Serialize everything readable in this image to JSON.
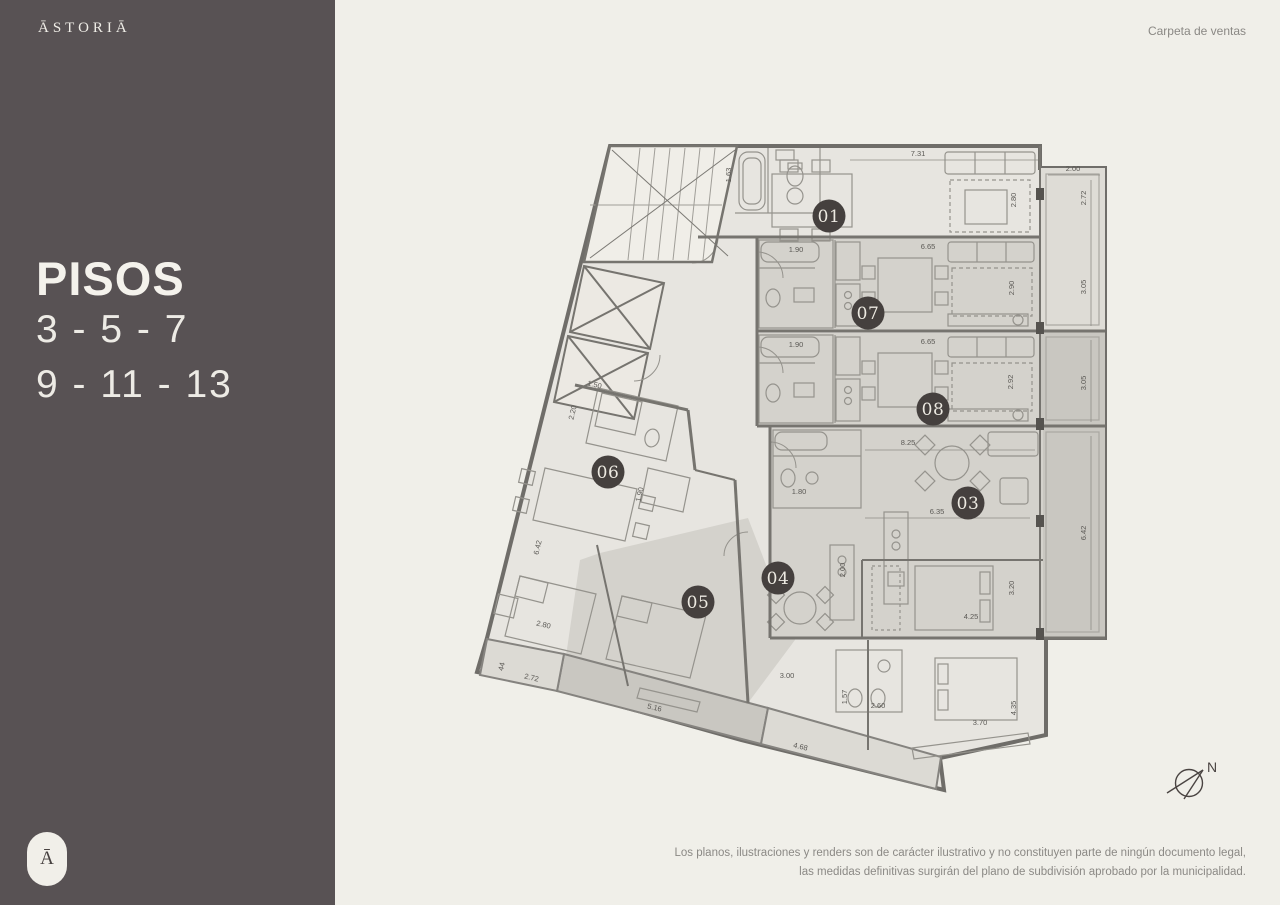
{
  "brand": {
    "logo": "ĀSTORIĀ",
    "monogram": "Ā"
  },
  "header": {
    "right_label": "Carpeta de ventas"
  },
  "sidebar": {
    "title": "PISOS",
    "line1": "3 - 5 - 7",
    "line2": "9 - 11 - 13"
  },
  "footer": {
    "disclaimer_line1": "Los planos, ilustraciones y renders son de carácter ilustrativo y no constituyen parte de ningún documento legal,",
    "disclaimer_line2": "las medidas definitivas surgirán del plano de subdivisión aprobado por la municipalidad."
  },
  "compass": {
    "label": "N"
  },
  "colors": {
    "sidebar": "#585254",
    "background": "#f0efe9",
    "badge": "#45403e",
    "badge_text": "#ece9e1",
    "plan_light": "#e7e5e0",
    "plan_shaded": "#d4d2cc",
    "balcony_dark": "#c9c7c1"
  },
  "plan": {
    "units": [
      {
        "n": "01",
        "x": 829,
        "y": 216
      },
      {
        "n": "07",
        "x": 868,
        "y": 313
      },
      {
        "n": "08",
        "x": 933,
        "y": 409
      },
      {
        "n": "03",
        "x": 968,
        "y": 503
      },
      {
        "n": "06",
        "x": 608,
        "y": 472
      },
      {
        "n": "04",
        "x": 778,
        "y": 578
      },
      {
        "n": "05",
        "x": 698,
        "y": 602
      }
    ],
    "dimensions": [
      {
        "t": "7.31",
        "x": 918,
        "y": 156,
        "r": 0
      },
      {
        "t": "1.63",
        "x": 731,
        "y": 175,
        "r": -90
      },
      {
        "t": "2.00",
        "x": 1073,
        "y": 171,
        "r": 0
      },
      {
        "t": "2.72",
        "x": 1086,
        "y": 198,
        "r": -90
      },
      {
        "t": "2.80",
        "x": 1016,
        "y": 200,
        "r": -90
      },
      {
        "t": "1.90",
        "x": 796,
        "y": 252,
        "r": 0
      },
      {
        "t": "6.65",
        "x": 928,
        "y": 249,
        "r": 0
      },
      {
        "t": "2.90",
        "x": 1014,
        "y": 288,
        "r": -90
      },
      {
        "t": "3.05",
        "x": 1086,
        "y": 287,
        "r": -90
      },
      {
        "t": "1.90",
        "x": 796,
        "y": 347,
        "r": 0
      },
      {
        "t": "6.65",
        "x": 928,
        "y": 344,
        "r": 0
      },
      {
        "t": "2.92",
        "x": 1013,
        "y": 382,
        "r": -90
      },
      {
        "t": "3.05",
        "x": 1086,
        "y": 383,
        "r": -90
      },
      {
        "t": "8.25",
        "x": 908,
        "y": 445,
        "r": 0
      },
      {
        "t": "1.80",
        "x": 799,
        "y": 494,
        "r": 0
      },
      {
        "t": "6.35",
        "x": 937,
        "y": 514,
        "r": 0
      },
      {
        "t": "6.42",
        "x": 1086,
        "y": 533,
        "r": -90
      },
      {
        "t": "1.50",
        "x": 594,
        "y": 387,
        "r": 13
      },
      {
        "t": "2.20",
        "x": 575,
        "y": 413,
        "r": -77
      },
      {
        "t": "1.90",
        "x": 642,
        "y": 495,
        "r": -77
      },
      {
        "t": "6.42",
        "x": 540,
        "y": 548,
        "r": -77
      },
      {
        "t": "2.80",
        "x": 543,
        "y": 627,
        "r": 13
      },
      {
        "t": "44",
        "x": 504,
        "y": 667,
        "r": -77
      },
      {
        "t": "2.72",
        "x": 531,
        "y": 680,
        "r": 13
      },
      {
        "t": "5.16",
        "x": 654,
        "y": 710,
        "r": 13
      },
      {
        "t": "4.68",
        "x": 800,
        "y": 749,
        "r": 13
      },
      {
        "t": "3.00",
        "x": 787,
        "y": 678,
        "r": 0
      },
      {
        "t": "2.00",
        "x": 845,
        "y": 570,
        "r": -90
      },
      {
        "t": "4.25",
        "x": 971,
        "y": 619,
        "r": 0
      },
      {
        "t": "3.20",
        "x": 1014,
        "y": 588,
        "r": -90
      },
      {
        "t": "2.60",
        "x": 878,
        "y": 708,
        "r": 0
      },
      {
        "t": "1.57",
        "x": 847,
        "y": 697,
        "r": -90
      },
      {
        "t": "3.70",
        "x": 980,
        "y": 725,
        "r": 0
      },
      {
        "t": "4.35",
        "x": 1016,
        "y": 708,
        "r": -90
      }
    ]
  }
}
